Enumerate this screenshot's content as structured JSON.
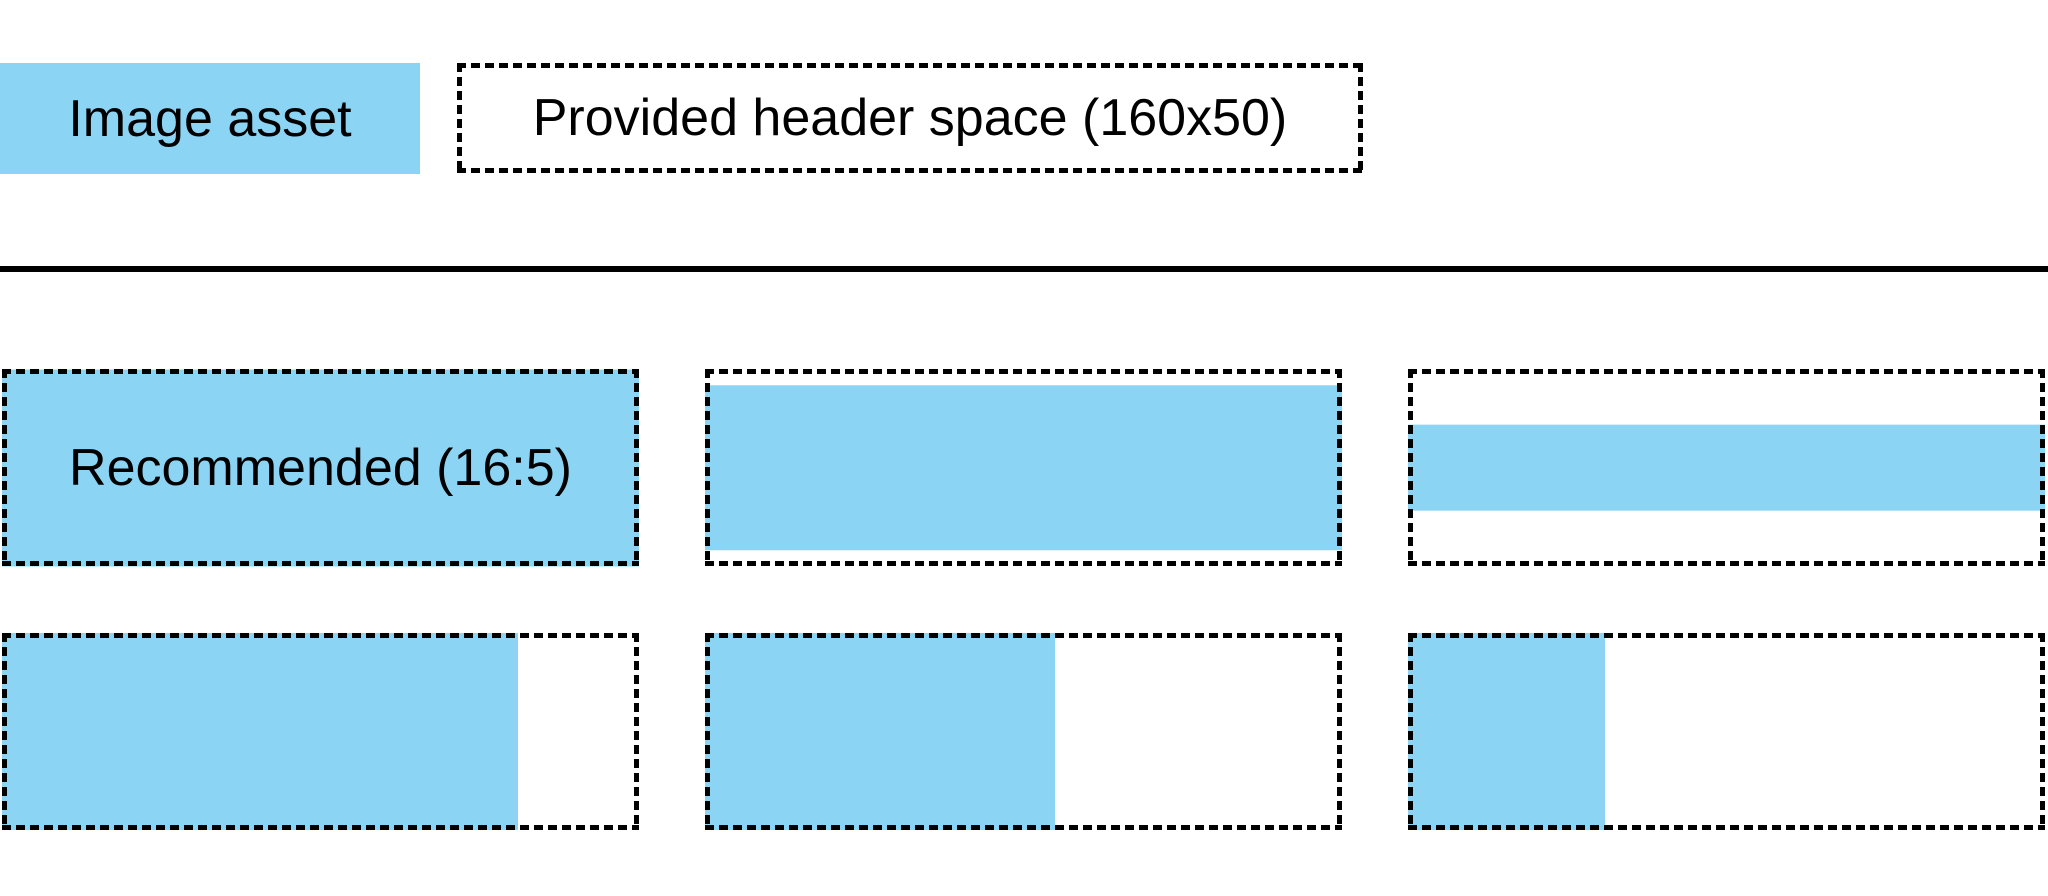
{
  "figure": {
    "colors": {
      "image_asset_blue": "#8BD4F4",
      "outline_black": "#000000",
      "background_white": "#ffffff"
    },
    "legend": {
      "image_asset_label": "Image asset",
      "header_space_label": "Provided header space (160x50)"
    },
    "examples": {
      "cells": [
        {
          "name": "recommended-16x5",
          "label": "Recommended (16:5)",
          "fill_width_pct": 100,
          "fill_height_pct": 100,
          "h_align": "left",
          "v_align": "middle"
        },
        {
          "name": "full-width-shorter-image",
          "label": "",
          "fill_width_pct": 100,
          "fill_height_pct": 84,
          "h_align": "left",
          "v_align": "middle"
        },
        {
          "name": "full-width-thin-strip",
          "label": "",
          "fill_width_pct": 100,
          "fill_height_pct": 44,
          "h_align": "left",
          "v_align": "middle"
        },
        {
          "name": "full-height-wide-image",
          "label": "",
          "fill_width_pct": 81,
          "fill_height_pct": 100,
          "h_align": "left",
          "v_align": "top"
        },
        {
          "name": "full-height-medium-image",
          "label": "",
          "fill_width_pct": 55,
          "fill_height_pct": 100,
          "h_align": "left",
          "v_align": "top"
        },
        {
          "name": "full-height-narrow-image",
          "label": "",
          "fill_width_pct": 31,
          "fill_height_pct": 100,
          "h_align": "left",
          "v_align": "top"
        }
      ]
    }
  }
}
